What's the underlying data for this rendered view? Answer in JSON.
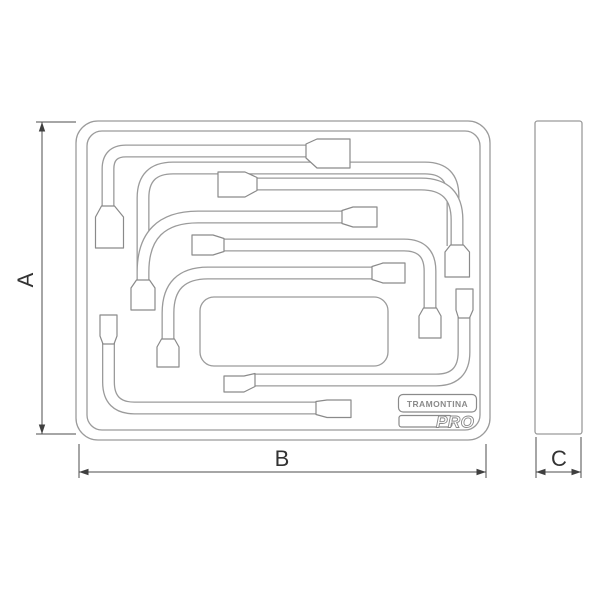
{
  "drawing": {
    "title_hint": "tool tray technical drawing",
    "dimension_labels": {
      "a": "A",
      "b": "B",
      "c": "C"
    },
    "logo": {
      "brand": "TRAMONTINA",
      "line": "PRO"
    },
    "colors": {
      "outline": "#9b9b9b",
      "socket_outline": "#8a8a8a",
      "dimension_line": "#4d4d4d",
      "label_text": "#333333",
      "background": "#ffffff"
    }
  }
}
